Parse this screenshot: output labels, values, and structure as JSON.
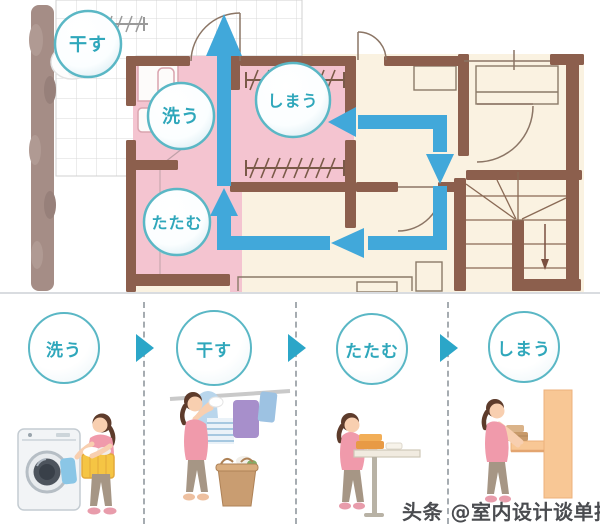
{
  "plan": {
    "circles": [
      {
        "id": "dry",
        "label": "干す"
      },
      {
        "id": "wash",
        "label": "洗う"
      },
      {
        "id": "store",
        "label": "しまう"
      },
      {
        "id": "fold",
        "label": "たたむ"
      }
    ]
  },
  "steps": [
    {
      "id": "wash",
      "label": "洗う"
    },
    {
      "id": "dry",
      "label": "干す"
    },
    {
      "id": "fold",
      "label": "たたむ"
    },
    {
      "id": "store",
      "label": "しまう"
    }
  ],
  "watermark": "头条 @室内设计谈单技巧",
  "colors": {
    "flow_arrow": "#41a8da",
    "label_teal": "#2fa7bb",
    "circle_ring": "#5ab7c5",
    "room_pink": "#f4c4d0",
    "wall_brown": "#8c5f4d",
    "floor_cream": "#faf2e1",
    "step_arrow": "#2ba6c8"
  }
}
